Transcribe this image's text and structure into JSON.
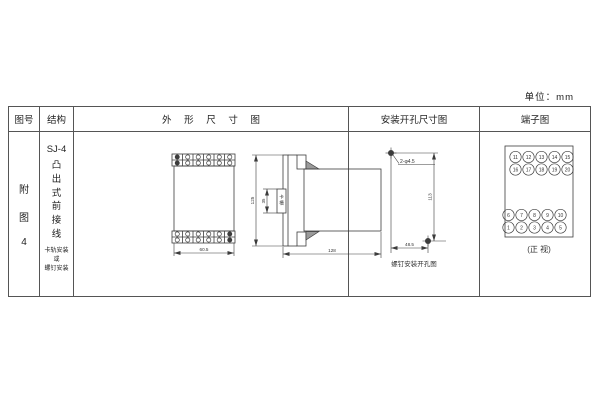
{
  "unit_label": "单位：mm",
  "header": {
    "col_figure": "图号",
    "col_structure": "结构",
    "col_outline": "外 形 尺 寸 图",
    "col_mounting": "安装开孔尺寸图",
    "col_terminal": "端子图"
  },
  "figure": {
    "char1": "附",
    "char2": "图",
    "char3": "4"
  },
  "structure": {
    "model": "SJ-4",
    "type_vertical": "凸出式前接线",
    "note_line1": "卡轨安装",
    "note_line2": "或",
    "note_line3": "螺钉安装"
  },
  "outline": {
    "front_width": "60.5",
    "height": "125",
    "slot_dim": "35",
    "slot_char1": "卡",
    "slot_char2": "槽",
    "depth": "128"
  },
  "mounting": {
    "holes_label": "2-φ4.5",
    "height_dim": "113",
    "width_dim": "48.5",
    "caption": "螺钉安装开孔图"
  },
  "terminal": {
    "row1": [
      "11",
      "12",
      "13",
      "14",
      "15"
    ],
    "row2": [
      "16",
      "17",
      "18",
      "19",
      "20"
    ],
    "row3": [
      "6",
      "7",
      "8",
      "9",
      "10"
    ],
    "row4": [
      "1",
      "2",
      "3",
      "4",
      "5"
    ],
    "caption": "(正 视)"
  }
}
